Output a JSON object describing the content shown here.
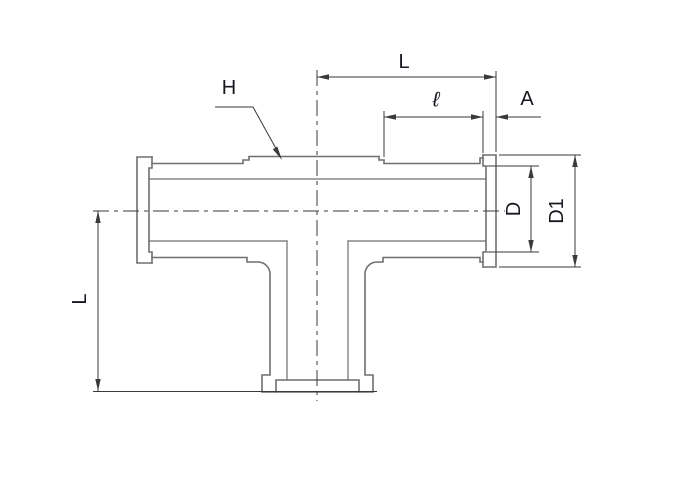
{
  "colors": {
    "background": "#ffffff",
    "outline": "#6f6f6f",
    "dimension": "#3a3a3a",
    "label": "#17171f"
  },
  "labels": {
    "dim_L_top": "L",
    "dim_ell": "ℓ",
    "dim_A": "A",
    "callout_H": "H",
    "dim_D": "D",
    "dim_D1": "D1",
    "dim_L_left": "L"
  }
}
